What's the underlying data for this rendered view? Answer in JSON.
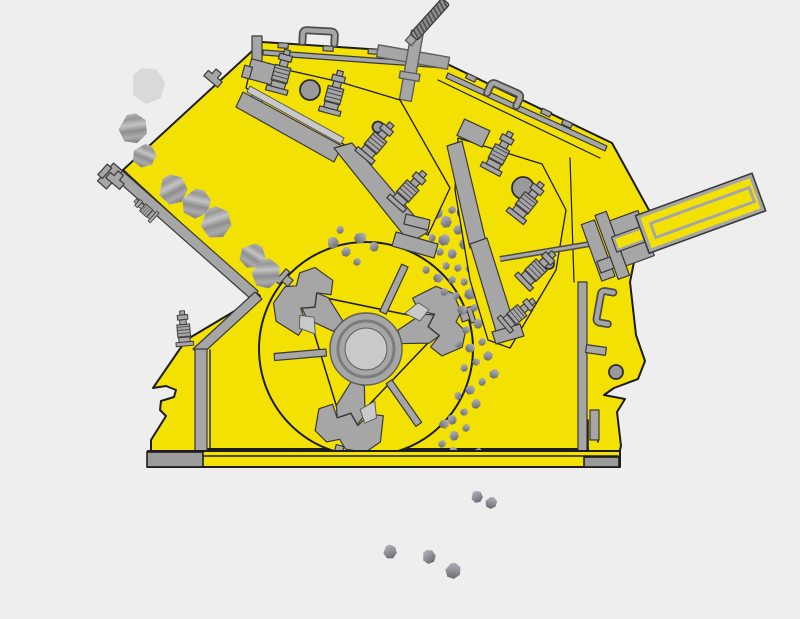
{
  "meta": {
    "description": "Cross-section diagram of an impact crusher: rocks are fed from the upper-left chute, broken by a three-hammer rotor against two spring-loaded breaker plates, crushed material discharges below the base",
    "background": "#eeeeee"
  },
  "colors": {
    "housing": "#f3e104",
    "outline": "#1c1c1c",
    "steel": "#a6a6a6",
    "steel_dark": "#5e5e5e",
    "steel_light": "#c9c9c9",
    "base_cap": "#9b9b9b",
    "rock_light": "#c8c8c8",
    "rock_dark": "#5c5c64",
    "rock_pale": "#d9d9d9"
  },
  "rotor": {
    "cx": 366,
    "cy": 349,
    "radius": 107,
    "hub_radii": [
      36,
      28,
      21
    ],
    "hammer_angles": [
      -18,
      105,
      221
    ],
    "spoke_angles": [
      295,
      55,
      175
    ]
  },
  "bolts": [
    [
      280,
      78,
      15,
      1.0
    ],
    [
      333,
      99,
      15,
      1.0
    ],
    [
      373,
      146,
      40,
      1.0
    ],
    [
      405,
      194,
      42,
      1.0
    ],
    [
      497,
      158,
      28,
      1.0
    ],
    [
      524,
      206,
      38,
      1.0
    ],
    [
      533,
      273,
      46,
      1.0
    ],
    [
      514,
      317,
      50,
      0.9
    ],
    [
      184,
      334,
      -5,
      0.8
    ],
    [
      148,
      212,
      -48,
      0.6
    ]
  ],
  "rocks": {
    "feed": [
      [
        148,
        86,
        18,
        10,
        1
      ],
      [
        133,
        129,
        15,
        40,
        0
      ],
      [
        144,
        156,
        12,
        70,
        0
      ],
      [
        173,
        190,
        15,
        20,
        0
      ],
      [
        196,
        204,
        15,
        60,
        0
      ],
      [
        216,
        223,
        16,
        30,
        0
      ],
      [
        252,
        256,
        13,
        80,
        0
      ],
      [
        266,
        274,
        15,
        45,
        0
      ]
    ],
    "crushing": [
      [
        333,
        243,
        6,
        10
      ],
      [
        346,
        252,
        5,
        50
      ],
      [
        360,
        238,
        6,
        90
      ],
      [
        374,
        247,
        5,
        20
      ],
      [
        357,
        262,
        4,
        70
      ],
      [
        340,
        230,
        4,
        30
      ],
      [
        424,
        206,
        5,
        15
      ],
      [
        437,
        213,
        6,
        55
      ],
      [
        430,
        224,
        4,
        95
      ],
      [
        446,
        222,
        6,
        25
      ],
      [
        452,
        210,
        4,
        65
      ],
      [
        458,
        230,
        5,
        35
      ],
      [
        444,
        240,
        6,
        75
      ],
      [
        432,
        238,
        4,
        5
      ],
      [
        420,
        232,
        4,
        45
      ],
      [
        465,
        244,
        6,
        85
      ],
      [
        452,
        254,
        5,
        15
      ],
      [
        440,
        252,
        4,
        55
      ],
      [
        470,
        256,
        5,
        95
      ],
      [
        478,
        248,
        4,
        25
      ],
      [
        484,
        262,
        6,
        65
      ],
      [
        470,
        268,
        5,
        35
      ],
      [
        458,
        268,
        4,
        75
      ],
      [
        446,
        266,
        4,
        5
      ],
      [
        490,
        274,
        5,
        45
      ],
      [
        478,
        280,
        6,
        85
      ],
      [
        464,
        282,
        4,
        15
      ],
      [
        452,
        280,
        4,
        55
      ],
      [
        438,
        278,
        5,
        95
      ],
      [
        426,
        270,
        4,
        25
      ],
      [
        496,
        288,
        5,
        65
      ],
      [
        484,
        292,
        4,
        35
      ],
      [
        470,
        294,
        6,
        75
      ],
      [
        456,
        296,
        4,
        5
      ],
      [
        444,
        292,
        4,
        45
      ],
      [
        500,
        302,
        4,
        85
      ],
      [
        488,
        306,
        5,
        15
      ],
      [
        474,
        308,
        4,
        55
      ],
      [
        462,
        310,
        5,
        95
      ],
      [
        504,
        318,
        5,
        25
      ],
      [
        492,
        322,
        4,
        65
      ],
      [
        478,
        324,
        5,
        35
      ],
      [
        466,
        330,
        4,
        75
      ],
      [
        496,
        336,
        5,
        5
      ],
      [
        482,
        342,
        4,
        45
      ],
      [
        470,
        348,
        5,
        85
      ],
      [
        458,
        344,
        4,
        15
      ],
      [
        488,
        356,
        5,
        55
      ],
      [
        476,
        362,
        4,
        95
      ],
      [
        464,
        368,
        4,
        25
      ],
      [
        494,
        374,
        5,
        65
      ],
      [
        482,
        382,
        4,
        35
      ],
      [
        470,
        390,
        5,
        75
      ],
      [
        458,
        396,
        4,
        5
      ],
      [
        476,
        404,
        5,
        45
      ],
      [
        464,
        412,
        4,
        85
      ],
      [
        452,
        420,
        5,
        15
      ],
      [
        466,
        428,
        4,
        55
      ],
      [
        444,
        424,
        5,
        95
      ],
      [
        454,
        436,
        5,
        25
      ],
      [
        442,
        444,
        4,
        65
      ],
      [
        453,
        452,
        5,
        35
      ],
      [
        478,
        452,
        4,
        75
      ]
    ],
    "discharge": [
      [
        477,
        497,
        6,
        20
      ],
      [
        491,
        503,
        6,
        60
      ],
      [
        390,
        552,
        7,
        30
      ],
      [
        429,
        557,
        7,
        10
      ],
      [
        453,
        571,
        8,
        50
      ]
    ]
  }
}
